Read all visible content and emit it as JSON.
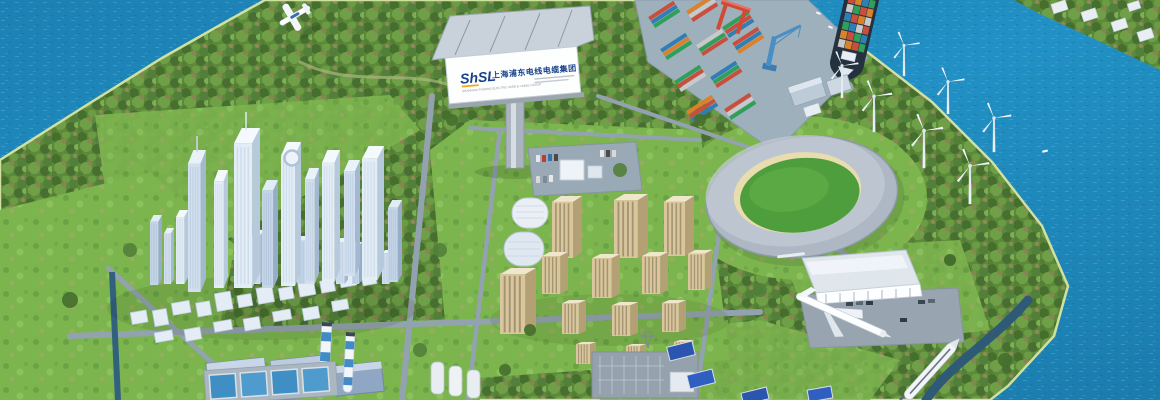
{
  "billboard": {
    "logo_text": "ShSL",
    "company_name_cn": "上海浦东电线电缆集团",
    "company_name_en": "SHANGHAI PUDONG ELECTRIC WIRE & CABLE GROUP",
    "logo_color": "#17418c",
    "accent_color": "#f5a81c"
  },
  "colors": {
    "water": "#1f87ba",
    "water_deep": "#15698f",
    "water_light": "#2b9ccd",
    "forest": "#5d8a3a",
    "grass": "#7cb44e",
    "road": "#93a2af",
    "pavement": "#9fb0bd",
    "city_building": "#dde8f2",
    "apartment_beige": "#d9c69c",
    "stadium_roof": "#aeb8c4",
    "stadium_field": "#4f9e3d",
    "stadium_rim": "#e9dcae",
    "crane_red": "#d14a35",
    "crane_blue": "#4a8fc4",
    "chimney_stripe": "#2f7fc1",
    "train_body": "#f2f5f8",
    "ship_hull": "#24313f"
  },
  "scene_objects": [
    "river-water",
    "forest-island",
    "cbd-skyline",
    "company-billboard",
    "container-port",
    "gantry-cranes",
    "container-ship",
    "far-shore-apartments",
    "wind-turbine-farm",
    "oval-stadium",
    "residential-complex",
    "cylinder-office-towers",
    "exhibition-hall",
    "display-jet-plane",
    "power-plant",
    "striped-chimneys",
    "storage-tanks",
    "substation",
    "high-speed-train",
    "light-aircraft",
    "treatment-pools",
    "road-network"
  ]
}
